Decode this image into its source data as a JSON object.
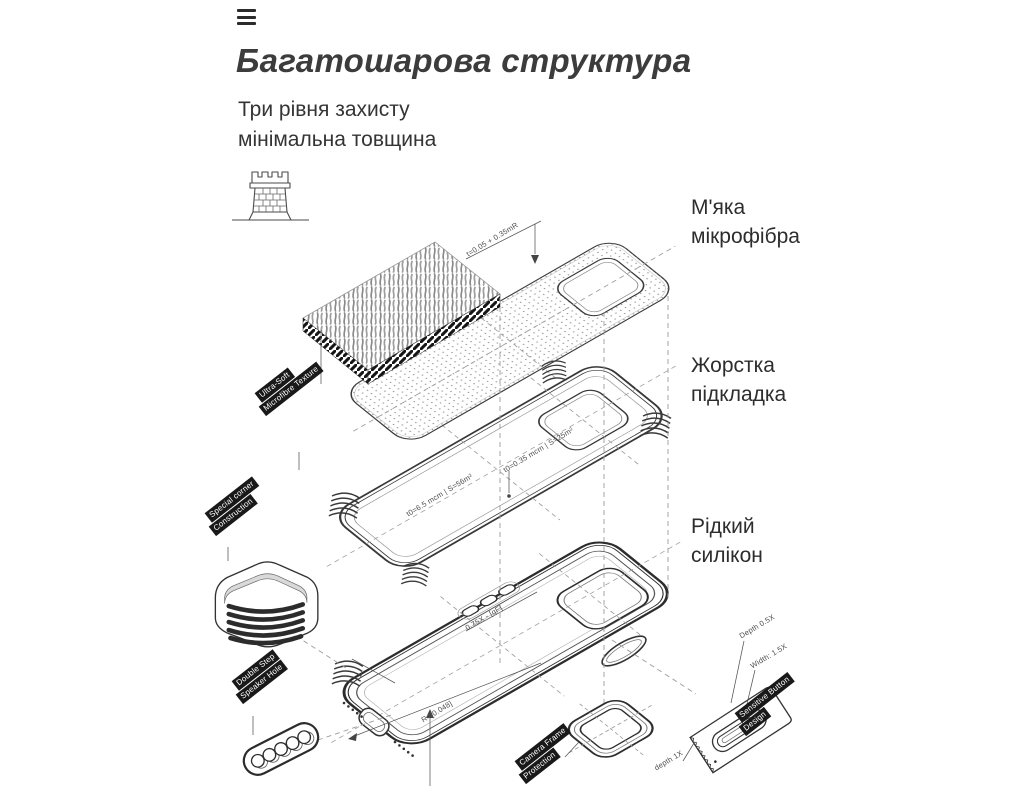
{
  "colors": {
    "background": "#ffffff",
    "line_art": "#3a3a3a",
    "tag_background": "#191919",
    "tag_text": "#ffffff",
    "heading_text": "#3c3c3c",
    "body_text": "#2d2d2d",
    "annotation_text": "#4f4f4f"
  },
  "header": {
    "title": "Багатошарова структура",
    "subtitle": [
      "Три рівня захисту",
      "мінімальна товщина"
    ]
  },
  "menu": {
    "icon": "hamburger-icon"
  },
  "hero_icon": "castle-tower",
  "layer_callouts": [
    {
      "id": "soft-microfiber",
      "lines": [
        "М'яка",
        "мікрофібра"
      ]
    },
    {
      "id": "hard-lining",
      "lines": [
        "Жорстка",
        "підкладка"
      ]
    },
    {
      "id": "liquid-silicone",
      "lines": [
        "Рідкий",
        "силікон"
      ]
    }
  ],
  "diagram": {
    "tags": [
      {
        "id": "ultra-soft-texture",
        "lines": [
          "Ultra-Soft",
          "Microfibre Texture"
        ]
      },
      {
        "id": "special-corner",
        "lines": [
          "Special corner",
          "Construction"
        ]
      },
      {
        "id": "double-step-speaker",
        "lines": [
          "Double Step",
          "Speaker Hole"
        ]
      },
      {
        "id": "camera-frame",
        "lines": [
          "Camera Frame",
          "Protection"
        ]
      },
      {
        "id": "sensitive-button",
        "lines": [
          "Sensitive Button",
          "Design"
        ]
      }
    ],
    "annotations": [
      "t=0.05 + 0.35mR",
      "t0=0.35 mcm | S=25m²",
      "t0=6.5 mcm | S=56m²",
      "0.75X - [qF]",
      "R=[0.048]",
      "Depth 0.5X",
      "Width: 1.5X",
      "depth 1X"
    ]
  }
}
